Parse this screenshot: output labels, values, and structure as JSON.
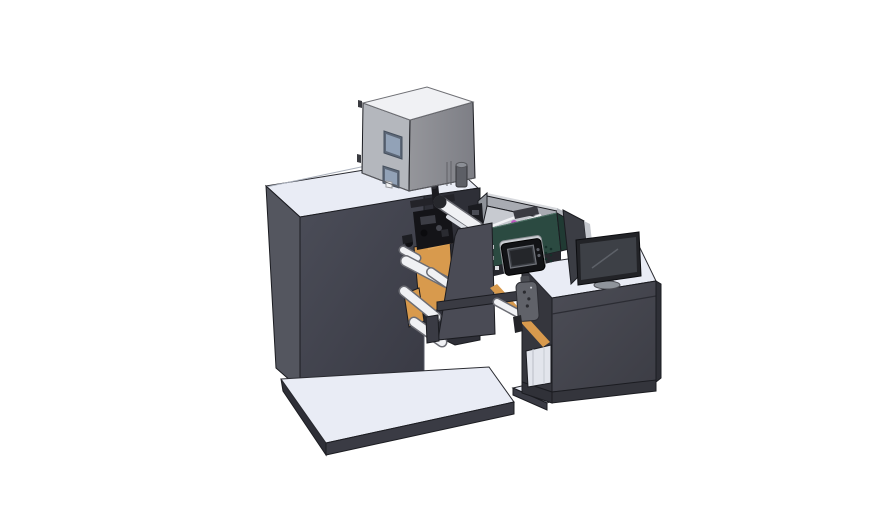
{
  "meta": {
    "description": "3D CAD rendering of an industrial label printing / rewinding machine with enclosure cabinet, inkjet module, guide rollers and an operator desk with monitor",
    "background": "#ffffff"
  },
  "colors": {
    "machineTop": "#e9ecf5",
    "machineSide": "#54565f",
    "machineFront": "#41424c",
    "bayInterior": "#2e2f37",
    "framePlate": "#4a4b55",
    "platformTop": "#e9ecf5",
    "platformFront": "#3a3b44",
    "platformSide": "#2e2f37",
    "cabinetTop": "#f0f1f4",
    "cabinetSide": "#b4b7bd",
    "cabinetFront": "#8a8b91",
    "windowFrame": "#5d6878",
    "windowGlass": "#92a2b7",
    "rollerLight": "#f0f1f4",
    "rollerShade": "#6c6d74",
    "orange": "#d89a4d",
    "greenBody": "#2b4a41",
    "greenEnd": "#203a33",
    "trayWall": "#a8abb2",
    "trayFloor": "#c7cad0",
    "magenta": "#c05ac2",
    "mechBlack": "#141418",
    "panelFrame": "#cbced3",
    "panelBlack": "#121316",
    "panelScreen": "#3b3e44",
    "monitorFrame": "#222327",
    "monitorScreen": "#3d4046",
    "standGray": "#8f949b",
    "deskTop": "#e9ecf5",
    "deskFront": "#46474f",
    "deskSide": "#35363d",
    "shelfInterior": "#e2e5ec",
    "pendantGray": "#606269",
    "barDark": "#3a3b43"
  },
  "parts": [
    {
      "name": "machine-base-platform",
      "label": "machine base platform"
    },
    {
      "name": "machine-body",
      "label": "main machine cabinet"
    },
    {
      "name": "enclosure-cabinet",
      "label": "gray enclosure cabinet on top"
    },
    {
      "name": "exhaust-cylinder",
      "label": "small cylinder on machine top"
    },
    {
      "name": "roll-bay",
      "label": "unwind / web guide bay"
    },
    {
      "name": "guide-rollers",
      "label": "white guide rollers"
    },
    {
      "name": "web-guide-plates",
      "label": "orange web guide plates"
    },
    {
      "name": "print-head-mechanism",
      "label": "black print head mechanism"
    },
    {
      "name": "inkjet-module",
      "label": "green inkjet module with open tray"
    },
    {
      "name": "module-control-panel",
      "label": "black control panel with screen"
    },
    {
      "name": "connecting-rail",
      "label": "rail between machine and desk"
    },
    {
      "name": "control-pendant",
      "label": "hand-held control pendant"
    },
    {
      "name": "operator-desk",
      "label": "operator desk cabinet"
    },
    {
      "name": "desk-shelf",
      "label": "open shelf in desk"
    },
    {
      "name": "monitor",
      "label": "desktop monitor"
    },
    {
      "name": "monitor-back-panel",
      "label": "second panel behind monitor"
    },
    {
      "name": "desk-base-platform",
      "label": "desk base platform"
    }
  ]
}
